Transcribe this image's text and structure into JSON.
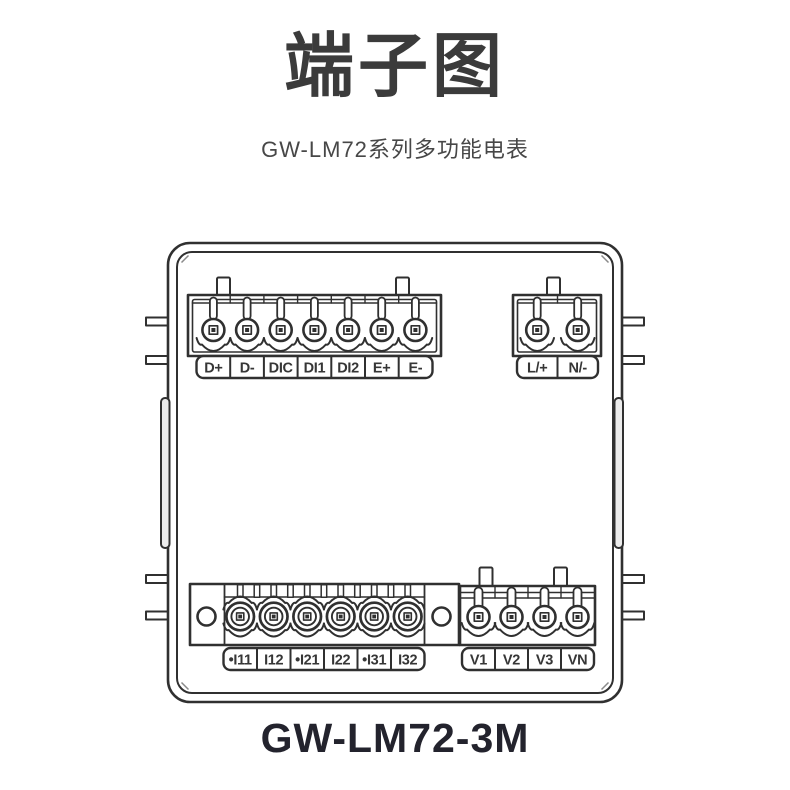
{
  "header": {
    "title": "端子图",
    "subtitle": "GW-LM72系列多功能电表"
  },
  "diagram": {
    "caption": "GW-LM72-3M",
    "line_color": "#303030",
    "blocks": {
      "comm": {
        "description": "communication and digital input terminal block",
        "labels": [
          "D+",
          "D-",
          "DIC",
          "DI1",
          "DI2",
          "E+",
          "E-"
        ]
      },
      "power": {
        "description": "auxiliary power terminal block",
        "labels": [
          "L/+",
          "N/-"
        ]
      },
      "current": {
        "description": "current input terminal block",
        "labels": [
          "•I11",
          "I12",
          "•I21",
          "I22",
          "•I31",
          "I32"
        ]
      },
      "voltage": {
        "description": "voltage input terminal block",
        "labels": [
          "V1",
          "V2",
          "V3",
          "VN"
        ]
      }
    }
  }
}
